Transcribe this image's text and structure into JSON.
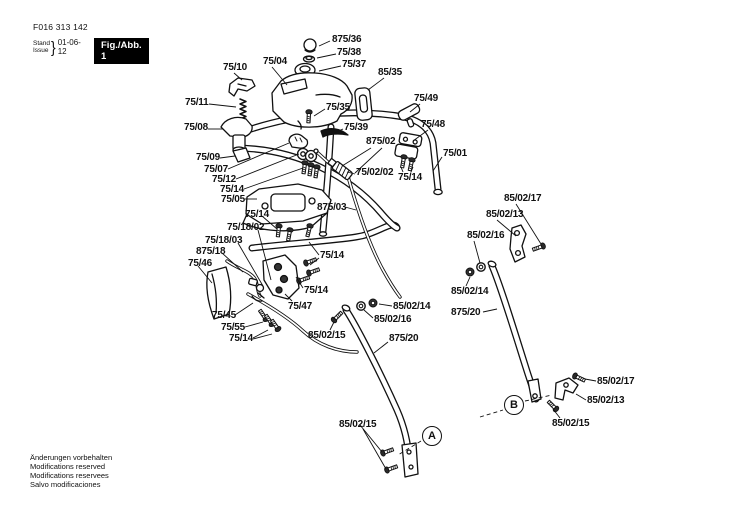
{
  "header": {
    "part_number": "F016 313 142",
    "stand_label": "Stand",
    "issue_label": "Issue",
    "brace": "}",
    "date": "01-06-12",
    "figure_label": "Fig./Abb. 1"
  },
  "footer": {
    "lines": [
      "Änderungen vorbehalten",
      "Modifications reserved",
      "Modifications reservees",
      "Salvo modificaciones"
    ]
  },
  "colors": {
    "ink": "#111111",
    "figure_box_bg": "#000000",
    "figure_box_fg": "#ffffff",
    "background": "#ffffff"
  },
  "diagram": {
    "callouts": [
      {
        "text": "A",
        "cx": 432,
        "cy": 436,
        "dashes": [
          [
            421,
            441,
            398,
            455
          ]
        ]
      },
      {
        "text": "B",
        "cx": 514,
        "cy": 405,
        "dashes": [
          [
            480,
            417,
            503,
            410
          ],
          [
            525,
            401,
            552,
            395
          ]
        ]
      }
    ],
    "labels": [
      {
        "text": "875/36",
        "x": 332,
        "y": 35,
        "lines": [
          [
            330,
            41,
            319,
            46
          ]
        ]
      },
      {
        "text": "75/38",
        "x": 337,
        "y": 48,
        "lines": [
          [
            336,
            54,
            317,
            58
          ]
        ]
      },
      {
        "text": "75/37",
        "x": 342,
        "y": 60,
        "lines": [
          [
            341,
            66,
            319,
            71
          ]
        ]
      },
      {
        "text": "75/04",
        "x": 263,
        "y": 57,
        "lines": [
          [
            272,
            67,
            287,
            85
          ]
        ]
      },
      {
        "text": "75/10",
        "x": 223,
        "y": 63,
        "lines": [
          [
            234,
            73,
            242,
            80
          ]
        ]
      },
      {
        "text": "85/35",
        "x": 378,
        "y": 68,
        "lines": [
          [
            384,
            78,
            368,
            90
          ]
        ]
      },
      {
        "text": "75/49",
        "x": 414,
        "y": 94,
        "lines": [
          [
            420,
            104,
            410,
            112
          ]
        ]
      },
      {
        "text": "75/11",
        "x": 185,
        "y": 98,
        "lines": [
          [
            209,
            104,
            236,
            107
          ]
        ]
      },
      {
        "text": "75/35",
        "x": 326,
        "y": 103,
        "lines": [
          [
            325,
            109,
            314,
            116
          ]
        ]
      },
      {
        "text": "75/48",
        "x": 421,
        "y": 120,
        "lines": [
          [
            428,
            130,
            413,
            141
          ]
        ]
      },
      {
        "text": "75/08",
        "x": 184,
        "y": 123,
        "lines": [
          [
            208,
            129,
            223,
            129
          ]
        ]
      },
      {
        "text": "75/39",
        "x": 344,
        "y": 123,
        "lines": [
          [
            343,
            129,
            334,
            133
          ]
        ]
      },
      {
        "text": "875/02",
        "x": 366,
        "y": 137,
        "lines": [
          [
            371,
            148,
            342,
            166
          ],
          [
            382,
            148,
            355,
            173
          ]
        ]
      },
      {
        "text": "75/01",
        "x": 443,
        "y": 149,
        "lines": [
          [
            442,
            157,
            433,
            171
          ]
        ]
      },
      {
        "text": "75/09",
        "x": 196,
        "y": 153,
        "lines": [
          [
            220,
            158,
            235,
            156
          ]
        ]
      },
      {
        "text": "75/07",
        "x": 204,
        "y": 165,
        "lines": [
          [
            228,
            169,
            289,
            143
          ]
        ]
      },
      {
        "text": "75/02/02",
        "x": 356,
        "y": 168,
        "lines": [
          [
            355,
            174,
            347,
            172
          ]
        ]
      },
      {
        "text": "75/14",
        "x": 398,
        "y": 173,
        "lines": [
          [
            403,
            172,
            401,
            167
          ],
          [
            411,
            172,
            413,
            167
          ]
        ]
      },
      {
        "text": "75/12",
        "x": 212,
        "y": 175,
        "lines": [
          [
            236,
            179,
            299,
            154
          ]
        ]
      },
      {
        "text": "75/14",
        "x": 220,
        "y": 185,
        "lines": [
          [
            244,
            189,
            303,
            168
          ]
        ]
      },
      {
        "text": "75/05",
        "x": 221,
        "y": 195,
        "lines": [
          [
            245,
            199,
            257,
            199
          ]
        ]
      },
      {
        "text": "875/03",
        "x": 317,
        "y": 203,
        "lines": [
          [
            345,
            207,
            356,
            210
          ]
        ]
      },
      {
        "text": "75/14",
        "x": 245,
        "y": 210,
        "lines": [
          [
            262,
            216,
            277,
            229
          ]
        ]
      },
      {
        "text": "75/18/02",
        "x": 227,
        "y": 223,
        "lines": [
          [
            258,
            230,
            271,
            280
          ]
        ]
      },
      {
        "text": "75/18/03",
        "x": 205,
        "y": 236,
        "lines": [
          [
            238,
            243,
            263,
            286
          ]
        ]
      },
      {
        "text": "875/18",
        "x": 196,
        "y": 247,
        "lines": [
          [
            222,
            253,
            243,
            272
          ]
        ]
      },
      {
        "text": "75/14",
        "x": 320,
        "y": 251,
        "lines": [
          [
            319,
            255,
            309,
            242
          ],
          [
            319,
            258,
            310,
            265
          ]
        ]
      },
      {
        "text": "75/46",
        "x": 188,
        "y": 259,
        "lines": [
          [
            198,
            266,
            212,
            283
          ]
        ]
      },
      {
        "text": "75/14",
        "x": 304,
        "y": 286,
        "lines": [
          [
            303,
            288,
            296,
            277
          ]
        ]
      },
      {
        "text": "75/47",
        "x": 288,
        "y": 302,
        "lines": [
          [
            292,
            301,
            285,
            294
          ]
        ]
      },
      {
        "text": "75/45",
        "x": 212,
        "y": 311,
        "lines": [
          [
            235,
            315,
            253,
            303
          ]
        ]
      },
      {
        "text": "75/55",
        "x": 221,
        "y": 323,
        "lines": [
          [
            245,
            327,
            263,
            322
          ]
        ]
      },
      {
        "text": "75/14",
        "x": 229,
        "y": 334,
        "lines": [
          [
            253,
            338,
            268,
            330
          ],
          [
            253,
            339,
            272,
            334
          ]
        ]
      },
      {
        "text": "85/02/15",
        "x": 308,
        "y": 331,
        "lines": [
          [
            330,
            330,
            334,
            322
          ]
        ]
      },
      {
        "text": "875/20",
        "x": 389,
        "y": 334,
        "lines": [
          [
            388,
            342,
            374,
            353
          ]
        ]
      },
      {
        "text": "85/02/14",
        "x": 393,
        "y": 302,
        "lines": [
          [
            392,
            306,
            379,
            304
          ]
        ]
      },
      {
        "text": "85/02/16",
        "x": 374,
        "y": 315,
        "lines": [
          [
            373,
            318,
            364,
            310
          ]
        ]
      },
      {
        "text": "85/02/15",
        "x": 339,
        "y": 420,
        "lines": [
          [
            360,
            425,
            382,
            452
          ],
          [
            363,
            429,
            386,
            469
          ]
        ]
      },
      {
        "text": "85/02/17",
        "x": 504,
        "y": 194,
        "lines": [
          [
            516,
            204,
            541,
            244
          ]
        ]
      },
      {
        "text": "85/02/13",
        "x": 486,
        "y": 210,
        "lines": [
          [
            497,
            220,
            516,
            236
          ]
        ]
      },
      {
        "text": "85/02/16",
        "x": 467,
        "y": 231,
        "lines": [
          [
            474,
            241,
            480,
            263
          ]
        ]
      },
      {
        "text": "85/02/14",
        "x": 451,
        "y": 287,
        "lines": [
          [
            466,
            286,
            470,
            277
          ]
        ]
      },
      {
        "text": "875/20",
        "x": 451,
        "y": 308,
        "lines": [
          [
            483,
            312,
            497,
            309
          ]
        ]
      },
      {
        "text": "85/02/17",
        "x": 597,
        "y": 377,
        "lines": [
          [
            596,
            381,
            585,
            379
          ]
        ]
      },
      {
        "text": "85/02/13",
        "x": 587,
        "y": 396,
        "lines": [
          [
            586,
            400,
            576,
            394
          ]
        ]
      },
      {
        "text": "85/02/15",
        "x": 552,
        "y": 419,
        "lines": [
          [
            560,
            418,
            553,
            409
          ]
        ]
      }
    ]
  }
}
